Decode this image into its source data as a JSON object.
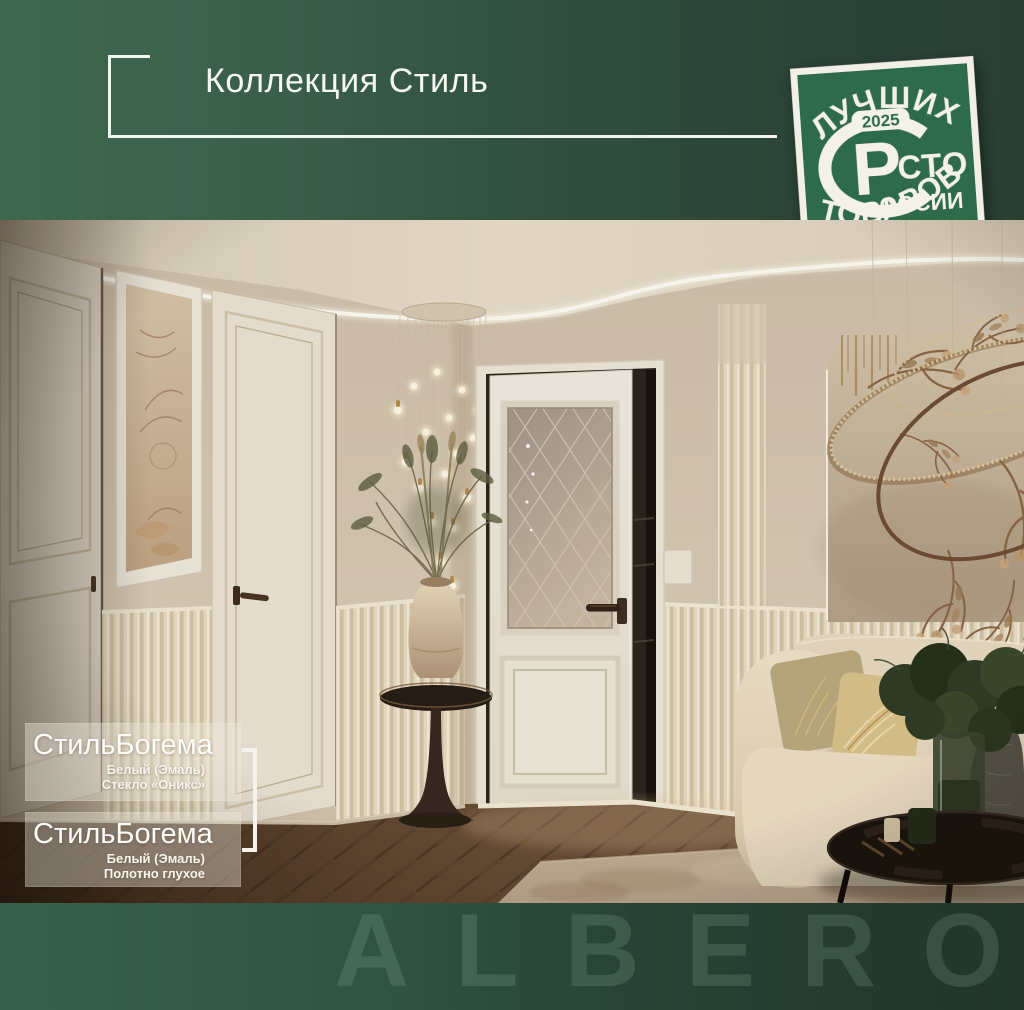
{
  "header": {
    "title": "Коллекция Стиль"
  },
  "badge": {
    "top": "ЛУЧШИХ",
    "year": "2025",
    "r": "Р",
    "sto": "СТО",
    "rossii": "ОССИИ",
    "bottom": "ТОВАРОВ"
  },
  "products": [
    {
      "name": "СтильБогема",
      "finish": "Белый (Эмаль)",
      "option": "Стекло «Оникс»"
    },
    {
      "name": "СтильБогема",
      "finish": "Белый (Эмаль)",
      "option": "Полотно глухое"
    }
  ],
  "footer": {
    "watermark": "ALBERO"
  },
  "colors": {
    "band_green_light": "#3e6850",
    "band_green_dark": "#293f34",
    "badge_green": "#2e6b4a",
    "badge_white": "#f4f1e8",
    "frame_white": "#f2f5ef",
    "watermark_green": "#96ba9f"
  }
}
